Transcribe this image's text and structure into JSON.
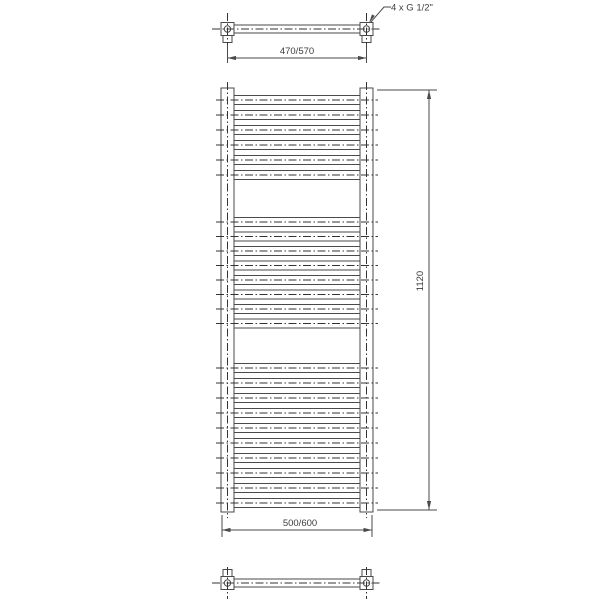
{
  "drawing": {
    "type": "technical-drawing-towel-radiator",
    "labels": {
      "connection_note": "4 x G 1/2\"",
      "top_width": "470/570",
      "height": "1120",
      "bottom_width": "500/600"
    },
    "rungs": {
      "total": 24,
      "groups": [
        {
          "count": 6,
          "start_y": 100,
          "pitch": 15
        },
        {
          "count": 8,
          "start_y": 222,
          "pitch": 14.5
        },
        {
          "count": 10,
          "start_y": 368,
          "pitch": 15
        }
      ]
    },
    "colors": {
      "background": "#ffffff",
      "line": "#4a4a4a",
      "centerline": "#333333",
      "text": "#3d3d3d"
    }
  }
}
